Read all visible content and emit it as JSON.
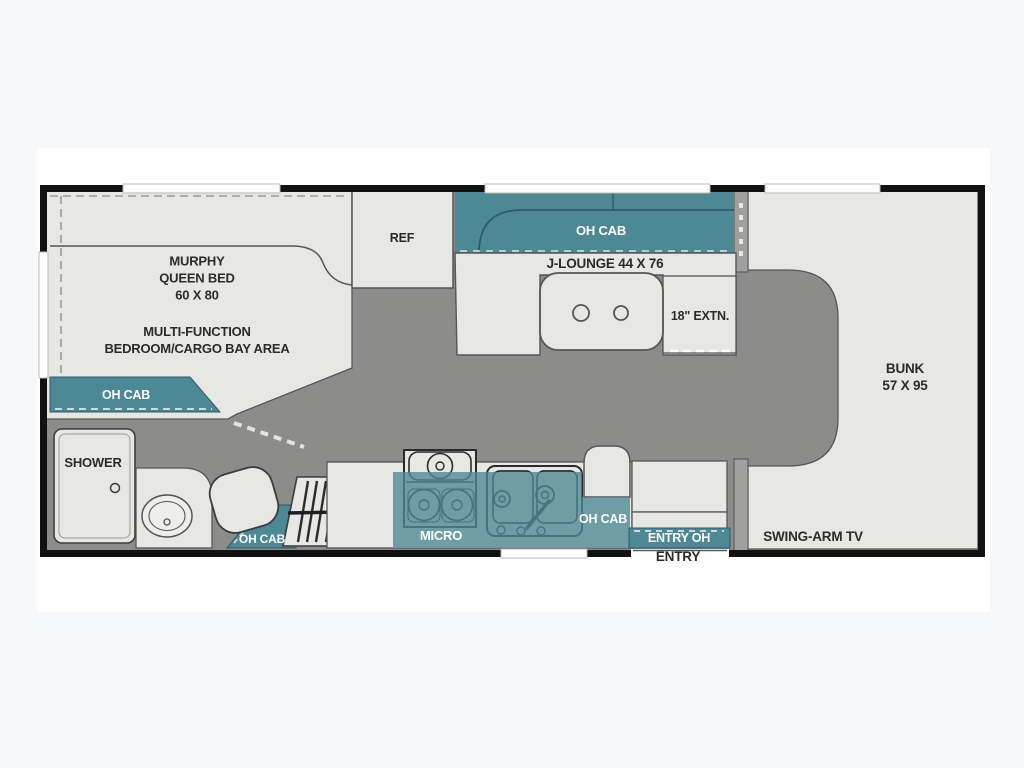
{
  "meta": {
    "type": "rv-floorplan",
    "accent_teal": "#4d8895",
    "wall_color": "#111111",
    "aisle_color": "#8c8c8a",
    "furniture_color": "#e7e7e3",
    "background": "#f7f8fa"
  },
  "plan": {
    "bedroom": {
      "murphy": "MURPHY\nQUEEN BED\n60 X 80",
      "area": "MULTI-FUNCTION\nBEDROOM/CARGO BAY AREA",
      "oh_cab": "OH CAB"
    },
    "kitchen": {
      "ref": "REF",
      "micro": "MICRO",
      "oh_cab": "OH CAB"
    },
    "lounge": {
      "oh_cab": "OH CAB",
      "name": "J-LOUNGE 44 X 76",
      "extension": "18\" EXTN."
    },
    "bath": {
      "shower": "SHOWER",
      "oh_cab": "OH CAB"
    },
    "entry": {
      "overhead": "ENTRY OH",
      "door": "ENTRY"
    },
    "bunk": {
      "name": "BUNK\n57 X 95",
      "tv": "SWING-ARM TV"
    }
  }
}
